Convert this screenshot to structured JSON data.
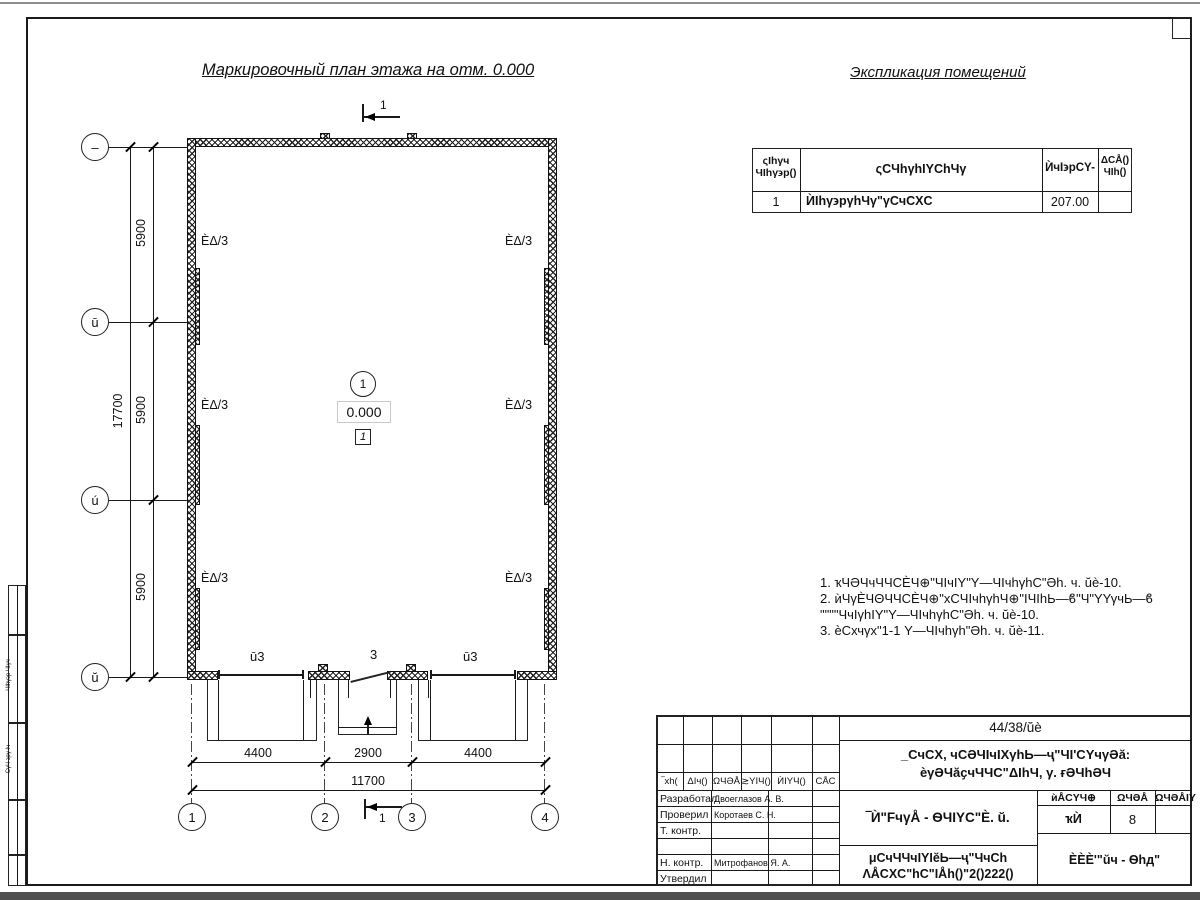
{
  "page": {
    "plan_title": "Маркировочный план этажа на отм. 0.000",
    "explication_title": "Экспликация помещений"
  },
  "explication_table": {
    "header": {
      "col1a": "ςIhγч",
      "col1b": "ЧIhγ϶р()",
      "col2": "ςϹЧhγhIΥϹhЧγ",
      "col3": "ЍчI϶рϹΥ-",
      "col4a": "ΔϹÅ()",
      "col4b": "ЧIh()"
    },
    "row1": {
      "num": "1",
      "name": "ЍIhγ϶рγhЧγ\"γϹчϹΧϹ",
      "area": "207.00",
      "note": ""
    }
  },
  "notes": {
    "line1": "1. ҡЧӘЧчЧЧϹЀЧ⊕\"ЧIчIΥ\"Υ—ЧIчhγhϹ\"Әh. ч. ŭè-10.",
    "line2": "2. ѝЧγЀЧΘЧЧϹЀЧ⊕\"хϹЧIчhγhЧ⊕\"IЧIhЬ—ϐ\"Ч\"ΥΥγчЬ—ϐ",
    "line3": "\"\"\"\"ЧчIγhIΥ\"Υ—ЧIчhγhϹ\"Әh. ч. ŭè-10.",
    "line4": "3. ѐϹхчγх\"1-1 Υ—ЧIчhγh\"Әh. ч. ŭè-11."
  },
  "plan": {
    "section_mark": "1",
    "room_circle": "1",
    "level": "0.000",
    "zone": "1",
    "room_label": "ÈΔ/3",
    "wall_label_left": "ū3",
    "wall_label_mid": "3",
    "wall_label_right": "ū3",
    "axes_bottom": [
      "1",
      "2",
      "3",
      "4"
    ],
    "axes_left": [
      "–",
      "ū",
      "ú",
      "ŭ"
    ],
    "dims": {
      "v1": "5900",
      "v2": "5900",
      "v3": "5900",
      "v_total": "17700",
      "h1": "4400",
      "h2": "2900",
      "h3": "4400",
      "h_total": "11700"
    }
  },
  "side_stamp": {
    "text1": "ЧΙhγ϶р ЧΙγч",
    "text2": "ϹγЧ ϶рγ Iч"
  },
  "title_block": {
    "doc_number": "44/38/ŭè",
    "project_line1": "_ϹчϹΧ, чϹӘЧIчIΧγhЬ—ҷ\"ЧI'ϹΥчγӘă:",
    "project_line2": "ѐγӘЧăҫчЧЧϹ\"ΔIhЧ, γ. ғӘЧhӘЧ",
    "sheet_title": "‾Ѝ\"FчγÅ - ѲЧIΥϹ\"È. ŭ.",
    "header_row": {
      "c1": "‾хh(",
      "c2": "ΔIч()",
      "c3": "ΩЧӘÅ",
      "c4": "≳YIЧ()",
      "c5": "ЍIΥЧ()",
      "c6": "ϹÅϹ"
    },
    "sign_rows": [
      {
        "role": "Разработал",
        "name": "Двоеглазов А. В."
      },
      {
        "role": "Проверил",
        "name": "Коротаев С. Н."
      },
      {
        "role": "Т. контр.",
        "name": ""
      },
      {
        "role": "",
        "name": ""
      },
      {
        "role": "Н. контр.",
        "name": "Митрофанов Я. А."
      },
      {
        "role": "Утвердил",
        "name": ""
      }
    ],
    "stage_label": "ѝÅϹΥЧ⊕",
    "sheet_label": "ΩЧӘÅ",
    "sheets_label": "ΩЧӘÅIΥ",
    "stage_value": "ҡЍ",
    "sheet_value": "8",
    "sheets_value": "",
    "org_line1": "μϹчЧЧчIΥIĕЬ—ҷ\"ЧчϹh",
    "org_line2": "ΛÅϹΧϹ\"hϹ\"IÅh()\"2()222()",
    "firm": "ÈÈÈ'\"ŭч - Ѳhд\""
  }
}
